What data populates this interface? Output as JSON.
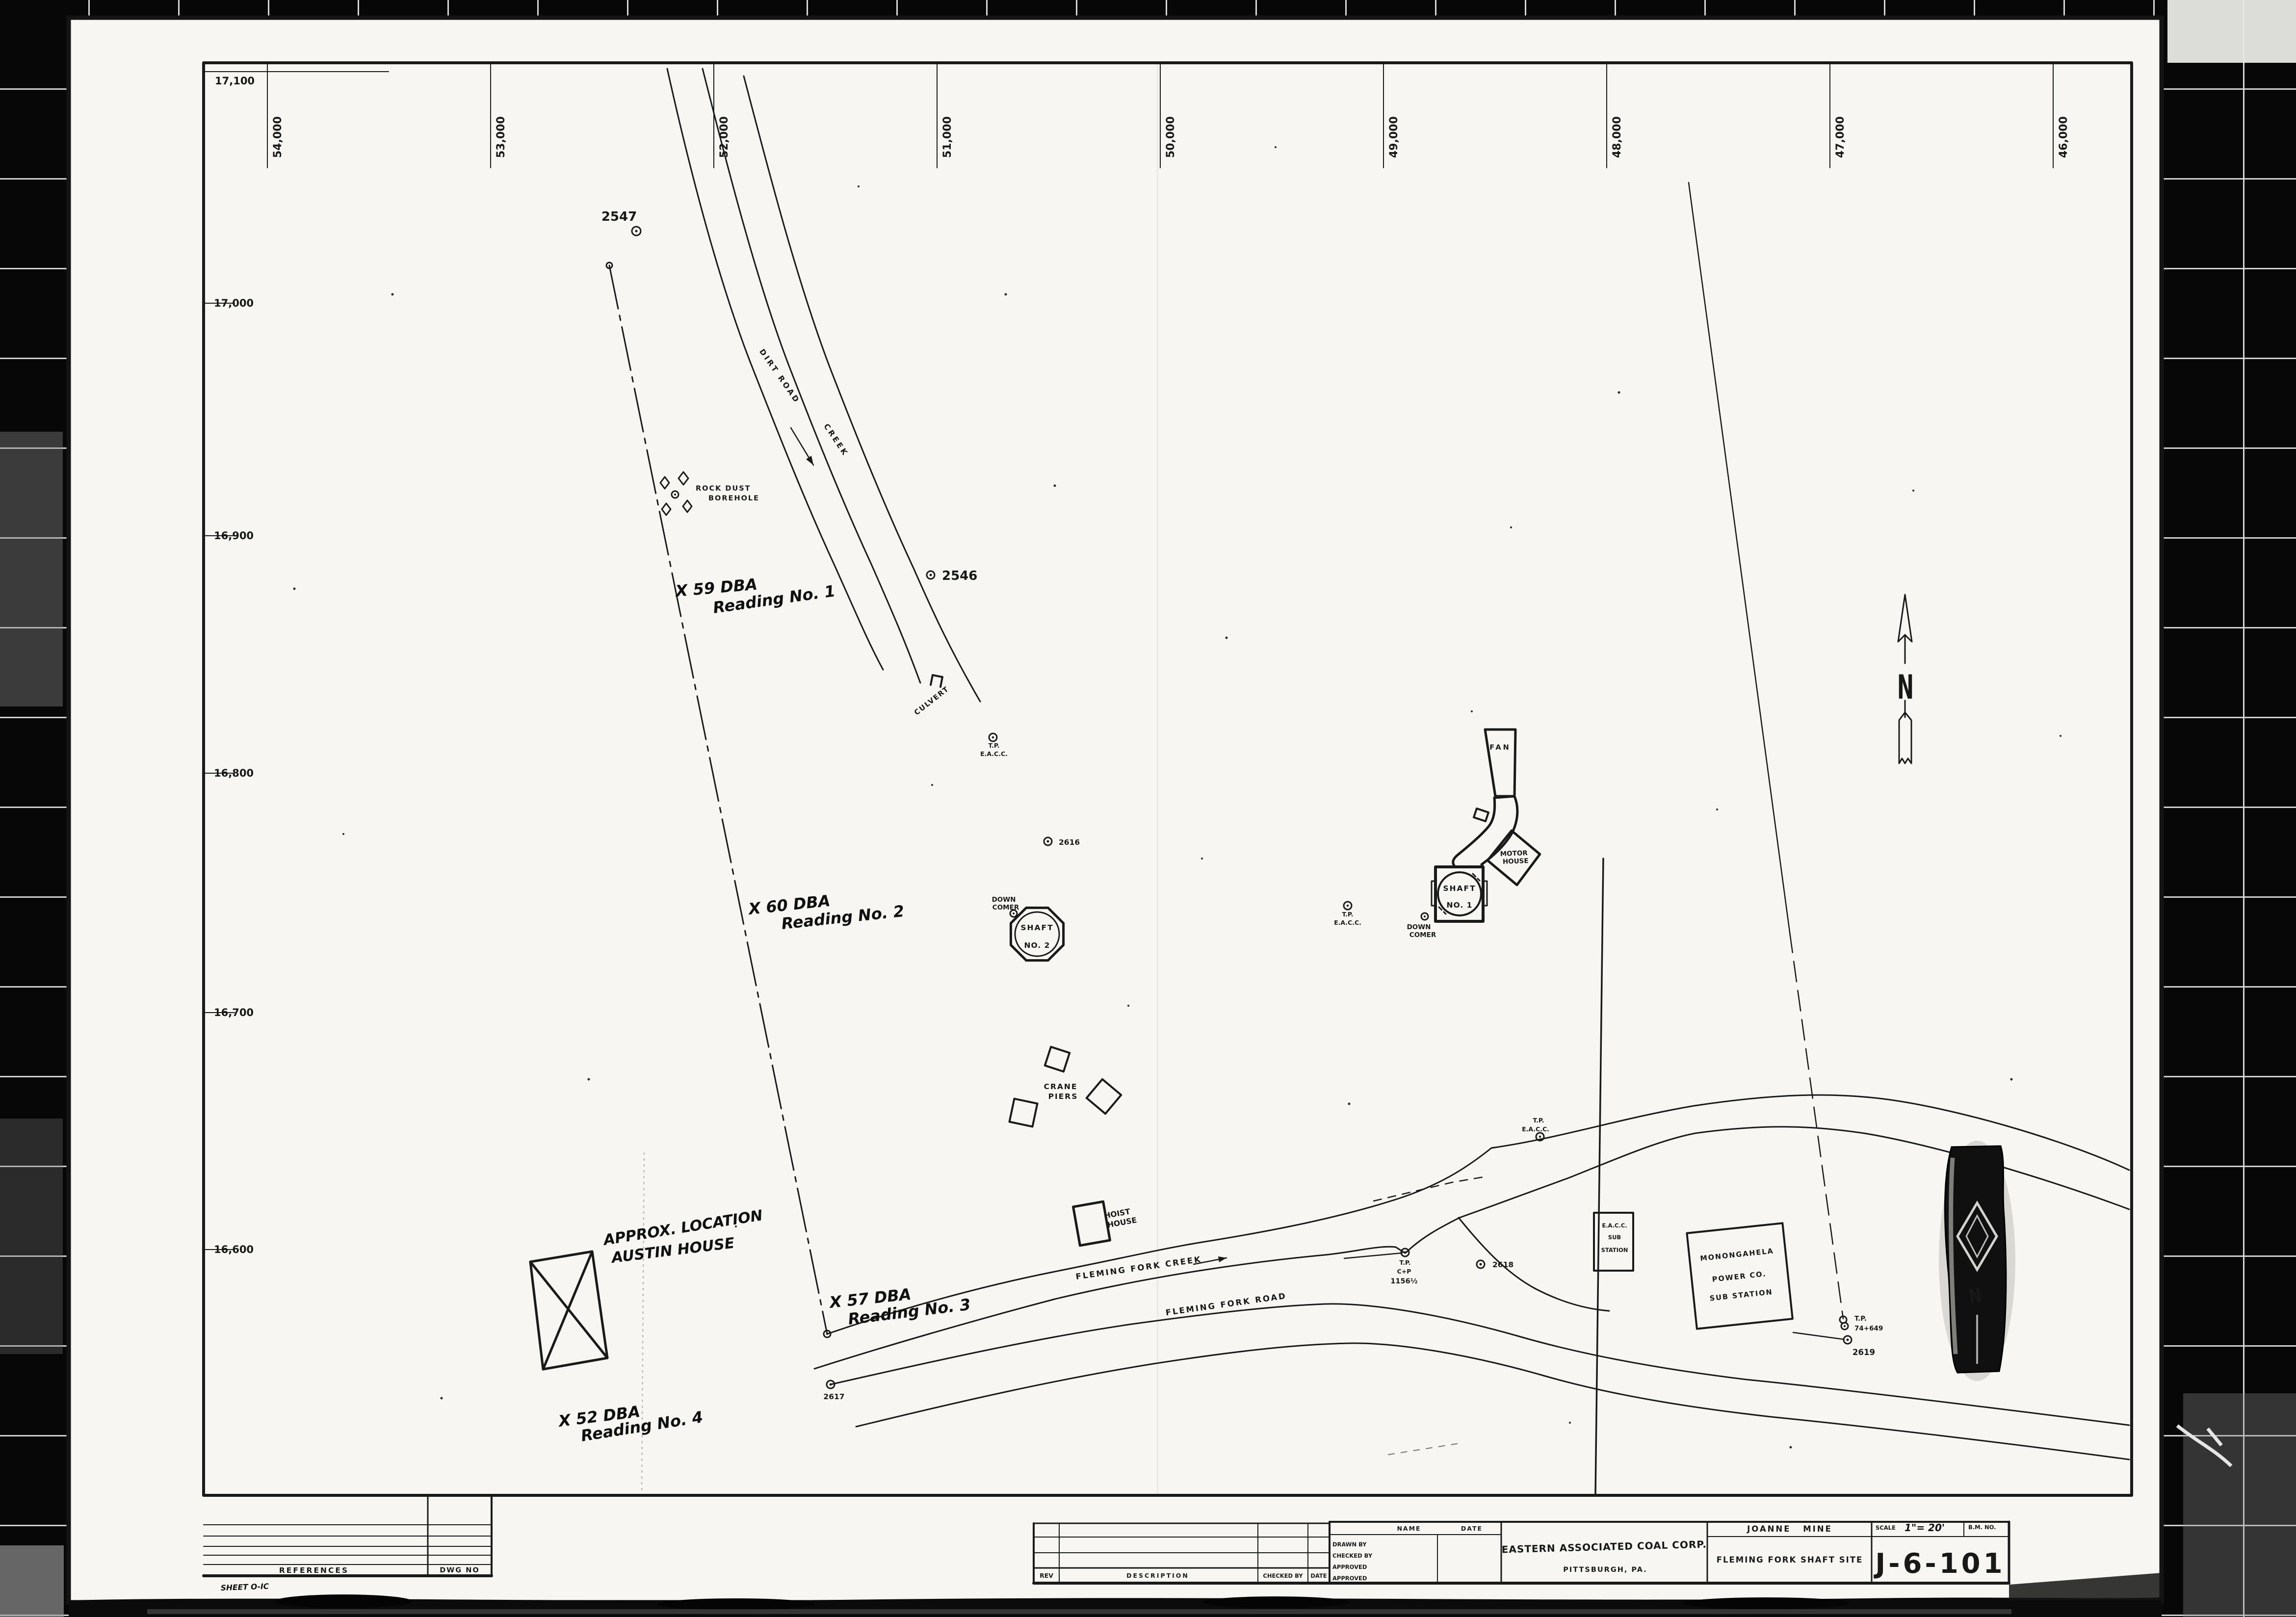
{
  "grid": {
    "top_ticks": [
      "54,000",
      "53,000",
      "52,000",
      "51,000",
      "50,000",
      "49,000",
      "48,000",
      "47,000",
      "46,000"
    ],
    "left_ticks": [
      "17,100",
      "17,000",
      "16,900",
      "16,800",
      "16,700",
      "16,600"
    ]
  },
  "map": {
    "roads": {
      "dirt_road": "DIRT ROAD",
      "creek": "CREEK",
      "fleming_fork_creek": "FLEMING FORK CREEK",
      "fleming_fork_road": "FLEMING FORK ROAD"
    },
    "features": {
      "rock_dust_1": "ROCK DUST",
      "rock_dust_2": "BOREHOLE",
      "culvert": "CULVERT",
      "fan": "FAN",
      "motor_house_1": "MOTOR",
      "motor_house_2": "HOUSE",
      "shaft_1a": "SHAFT",
      "shaft_1b": "NO. 1",
      "shaft_2a": "SHAFT",
      "shaft_2b": "NO. 2",
      "down_1": "DOWN",
      "down_2": "COMER",
      "crane_1": "CRANE",
      "crane_2": "PIERS",
      "hoist_1": "HOIST",
      "hoist_2": "HOUSE",
      "eacc_sub_1": "E.A.C.C.",
      "eacc_sub_2": "SUB",
      "eacc_sub_3": "STATION",
      "mon_sub_1": "MONONGAHELA",
      "mon_sub_2": "POWER CO.",
      "mon_sub_3": "SUB STATION",
      "north": "N"
    },
    "markers": {
      "tp": "T.P.",
      "eacc": "E.A.C.C.",
      "cp": "C+P",
      "cp_station": "1156½",
      "tp74": "74+649",
      "e2547": "2547",
      "e2546": "2546",
      "e2616": "2616",
      "e2617": "2617",
      "e2618": "2618",
      "e2619": "2619"
    },
    "handwritten": {
      "r1a": "X 59 DBA",
      "r1b": "Reading No. 1",
      "r2a": "X 60 DBA",
      "r2b": "Reading No. 2",
      "r3a": "X 57 DBA",
      "r3b": "Reading No. 3",
      "r4a": "X 52 DBA",
      "r4b": "Reading No. 4",
      "austin_1": "APPROX. LOCATION",
      "austin_2": "AUSTIN HOUSE"
    }
  },
  "title_block": {
    "references": "REFERENCES",
    "dwg_no": "DWG NO",
    "sheet_note": "SHEET O-IC",
    "rev": "REV",
    "description": "DESCRIPTION",
    "checked_by": "CHECKED BY",
    "date": "DATE",
    "name": "NAME",
    "drawn_by": "DRAWN BY",
    "approved": "APPROVED",
    "company": "EASTERN ASSOCIATED COAL CORP.",
    "city": "PITTSBURGH, PA.",
    "mine": "JOANNE MINE",
    "sheet_title": "FLEMING FORK SHAFT SITE",
    "scale_label": "SCALE",
    "scale_value": "1\"= 20'",
    "bm_no": "B.M. NO.",
    "dwg_number": "J-6-101"
  }
}
